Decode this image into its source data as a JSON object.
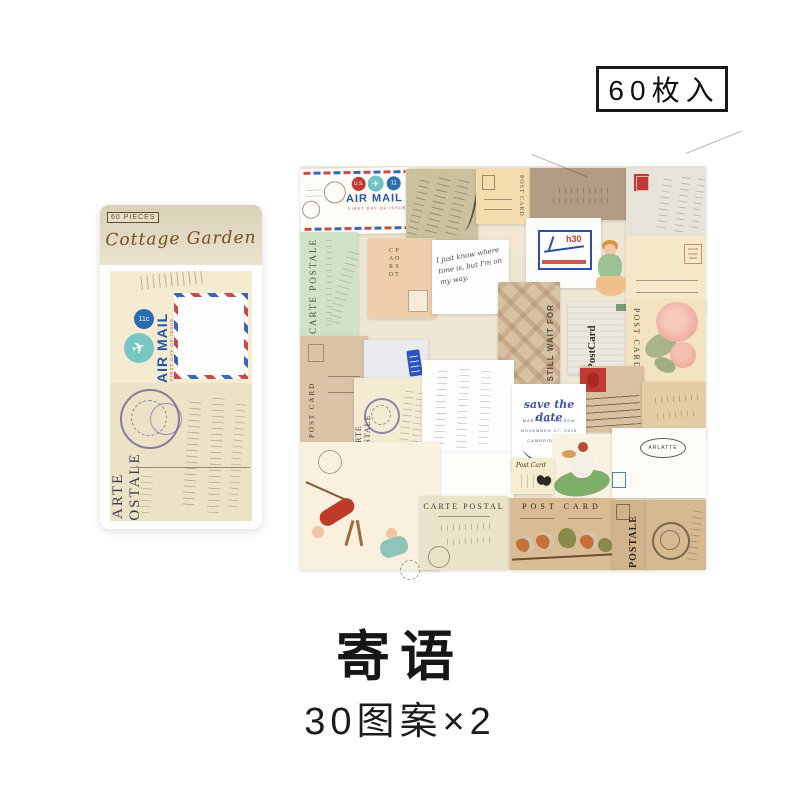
{
  "header_badge": {
    "text": "60枚入"
  },
  "package": {
    "pieces_badge": "60 PIECES",
    "brand": "Cottage Garden",
    "postcard": {
      "air_mail": "AIR MAIL",
      "first_day": "FIRST DAY OF ISSUE",
      "rate": "11c",
      "carte": "CARTE POSTALE"
    }
  },
  "collage": {
    "labels": {
      "air_mail": "AIR MAIL",
      "first_day": "FIRST DAY OF ISSUE",
      "us": "U.S.",
      "eleven": "11",
      "post_card": "POST CARD",
      "carte_postale": "CARTE POSTALE",
      "carte_postal": "CARTE POSTAL",
      "postcard_one_word": "PostCard",
      "post_card_script": "Post Card",
      "postale": "POSTALE",
      "still_wait": "I STILL WAIT FOR",
      "h30": "h30",
      "arlatte": "ARLATTE",
      "place_stamp": "PLACE STAMP HERE",
      "handwriting_note": "I just know where time is, but I'm on my way."
    },
    "save_the_date": {
      "title": "save the date",
      "names": "MARY AND WILSON",
      "date": "NOVEMBER 17, 2015",
      "location": "CAMBRIDGE, RI"
    }
  },
  "footer": {
    "title": "寄语",
    "subtitle": "30图案×2"
  },
  "icons": {
    "plane": "✈"
  },
  "colors": {
    "accent_black": "#1a1a1a",
    "brand_brown": "#7a4a1e",
    "airmail_blue": "#2456a8",
    "airmail_red": "#c94a4a",
    "stamp_blue": "#2b4faa",
    "stamp_red": "#c23b32",
    "save_date_blue": "#3f55a5",
    "postmark_purple": "#655a94"
  }
}
